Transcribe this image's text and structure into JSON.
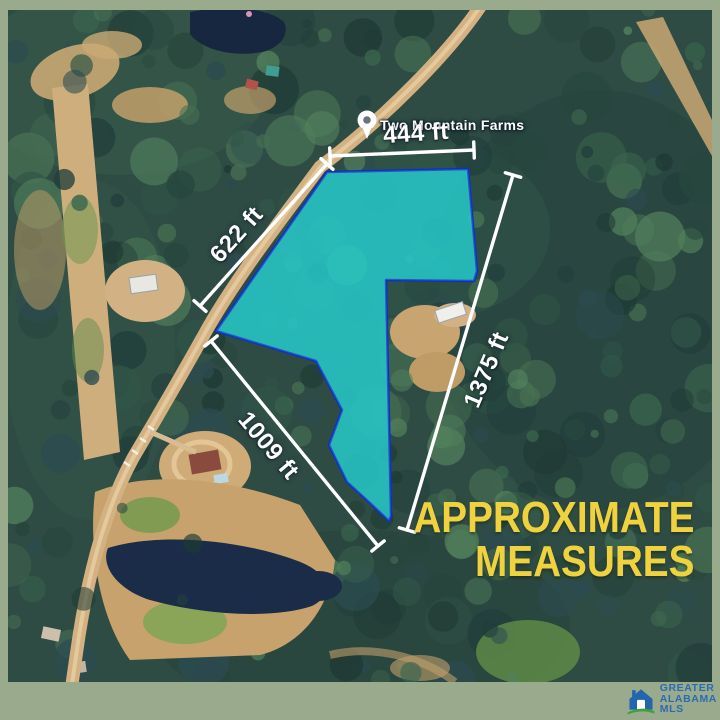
{
  "flyer": {
    "poi_label": "Two Mountain Farms",
    "measurements": {
      "top": "444 ft",
      "road": "622 ft",
      "lower_left": "1009 ft",
      "right": "1375 ft"
    },
    "title_line1": "APPROXIMATE",
    "title_line2": "MEASURES",
    "colors": {
      "frame_border": "#9AAA8C",
      "parcel_fill": "#1FC8CC",
      "parcel_border": "#1030C4",
      "measure_line": "#FFFFFF",
      "title_yellow": "#F0D23F",
      "logo_blue": "#2A6CB4",
      "logo_green": "#3FA03C"
    }
  },
  "logo": {
    "line1": "GREATER",
    "line2": "ALABAMA",
    "line3": "MLS"
  }
}
